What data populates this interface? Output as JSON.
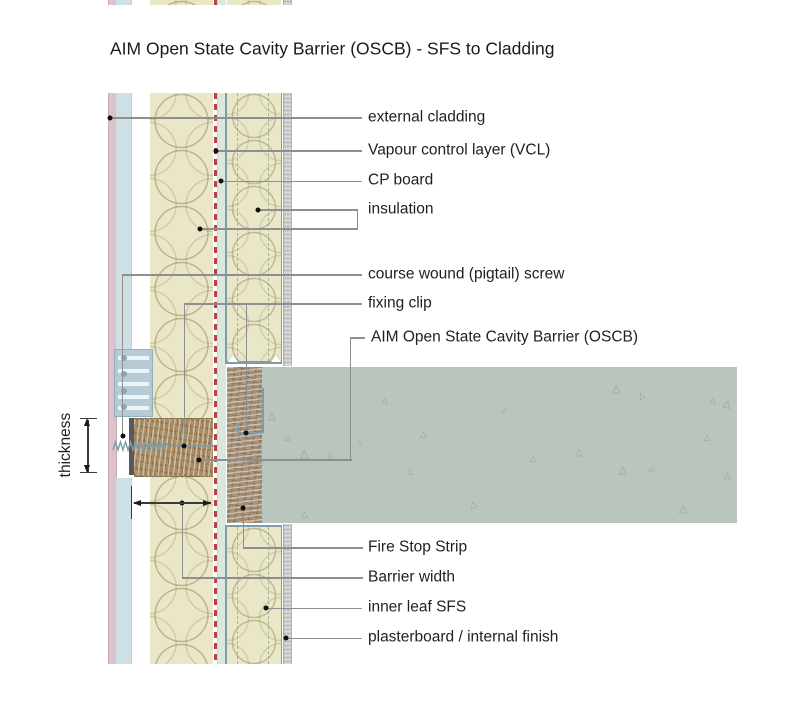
{
  "title": "AIM Open State Cavity Barrier (OSCB) - SFS to Cladding",
  "labels": {
    "external_cladding": "external cladding",
    "vapour_control_layer": "Vapour control layer (VCL)",
    "cp_board": "CP board",
    "insulation": "insulation",
    "pigtail_screw": "course wound (pigtail) screw",
    "fixing_clip": "fixing clip",
    "oscb": "AIM Open State Cavity Barrier (OSCB)",
    "fire_stop_strip": "Fire Stop Strip",
    "barrier_width": "Barrier width",
    "inner_leaf_sfs": "inner leaf SFS",
    "plasterboard": "plasterboard / internal finish",
    "thickness": "thickness"
  },
  "colors": {
    "cladding_face": "#dcc3cb",
    "cladding_panel": "#cfe0e5",
    "insulation": "#e9e7c7",
    "vcl_red": "#b5434c",
    "cp_board": "#dbe7dd",
    "steel_frame": "#7d9dad",
    "barrier_brown": "#a9906a",
    "barrier_edge": "#565a5e",
    "fire_strip": "#a6947e",
    "slab_concrete": "#bac5bd",
    "plasterboard": "#d6d8d4",
    "leader_line": "#8f8f8f",
    "text": "#1f1f1f"
  },
  "slab": {
    "aggregate_glyph": "△",
    "triangles": [
      [
        6,
        45,
        10,
        0
      ],
      [
        23,
        67,
        8,
        15
      ],
      [
        38,
        82,
        11,
        0
      ],
      [
        65,
        84,
        8,
        -20
      ],
      [
        95,
        72,
        7,
        0
      ],
      [
        158,
        63,
        9,
        0
      ],
      [
        145,
        101,
        8,
        0
      ],
      [
        208,
        133,
        9,
        -15
      ],
      [
        268,
        88,
        8,
        0
      ],
      [
        313,
        81,
        10,
        0
      ],
      [
        350,
        17,
        11,
        0
      ],
      [
        376,
        24,
        9,
        -25
      ],
      [
        448,
        30,
        8,
        0
      ],
      [
        461,
        33,
        10,
        15
      ],
      [
        442,
        67,
        8,
        0
      ],
      [
        357,
        99,
        10,
        0
      ],
      [
        387,
        98,
        8,
        20
      ],
      [
        462,
        104,
        9,
        0
      ],
      [
        417,
        137,
        11,
        0
      ],
      [
        39,
        143,
        9,
        0
      ],
      [
        120,
        30,
        8,
        0
      ],
      [
        240,
        40,
        7,
        0
      ]
    ]
  }
}
